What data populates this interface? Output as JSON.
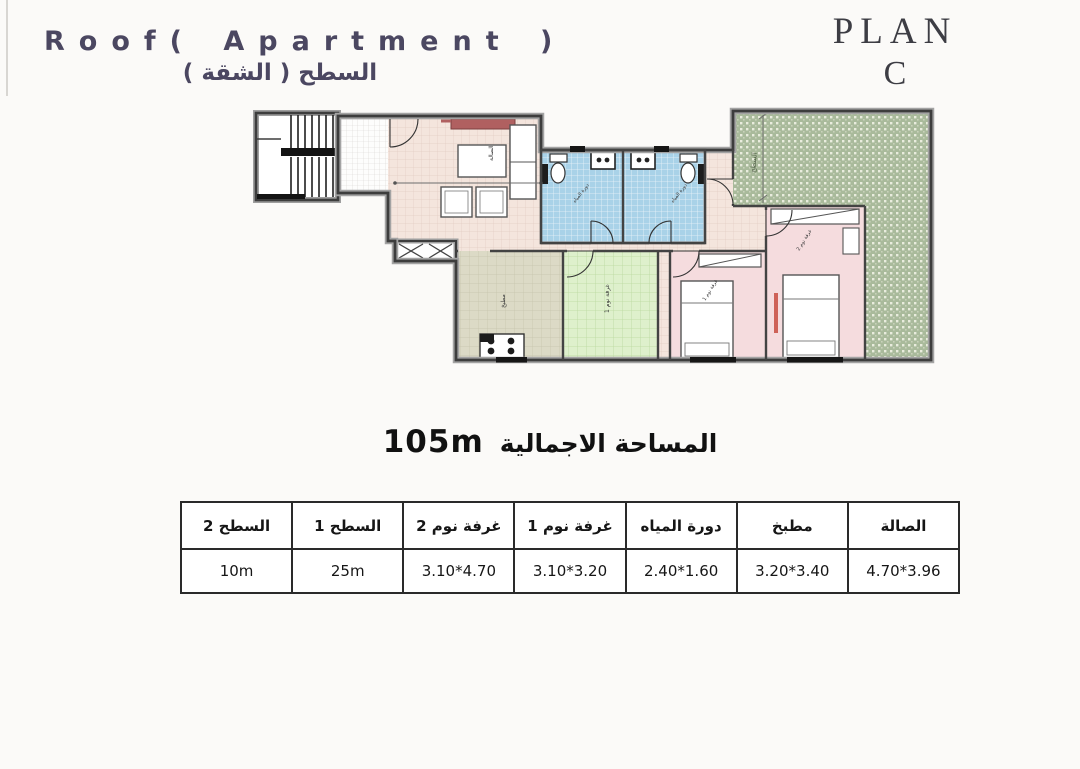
{
  "header": {
    "title_en": "Roof( Apartment )",
    "title_ar": "السطح ( الشقة )",
    "plan_word": "PLAN",
    "plan_letter": "C"
  },
  "area_summary": {
    "label_ar": "المساحة الاجمالية",
    "value": "105m"
  },
  "plan": {
    "rooms": {
      "living": "الصالة",
      "kitchen": "مطبخ",
      "bedroom1": "غرفة نوم 1",
      "bedroom2": "غرفة نوم 2",
      "bath1": "دورة المياه",
      "bath2": "دورة المياه",
      "roof_terrace": "السطح"
    },
    "colors": {
      "title": "#4b4761",
      "plan_label": "#3d3d44",
      "floor_living_pink": "#f4e5dd",
      "floor_bath_blue": "#a9d2e8",
      "floor_green_room": "#def0cc",
      "floor_kitchen_olive": "#dcdac6",
      "terrace_green": "#a9ba9b",
      "wall_dark": "#434343",
      "sofa_red": "#b06060"
    }
  },
  "dimensions_table": {
    "columns": [
      {
        "label": "السطح 2",
        "value": "10m"
      },
      {
        "label": "السطح 1",
        "value": "25m"
      },
      {
        "label": "غرفة نوم 2",
        "value": "3.10*4.70"
      },
      {
        "label": "غرفة نوم 1",
        "value": "3.10*3.20"
      },
      {
        "label": "دورة المياه",
        "value": "2.40*1.60"
      },
      {
        "label": "مطبخ",
        "value": "3.20*3.40"
      },
      {
        "label": "الصالة",
        "value": "4.70*3.96"
      }
    ]
  }
}
